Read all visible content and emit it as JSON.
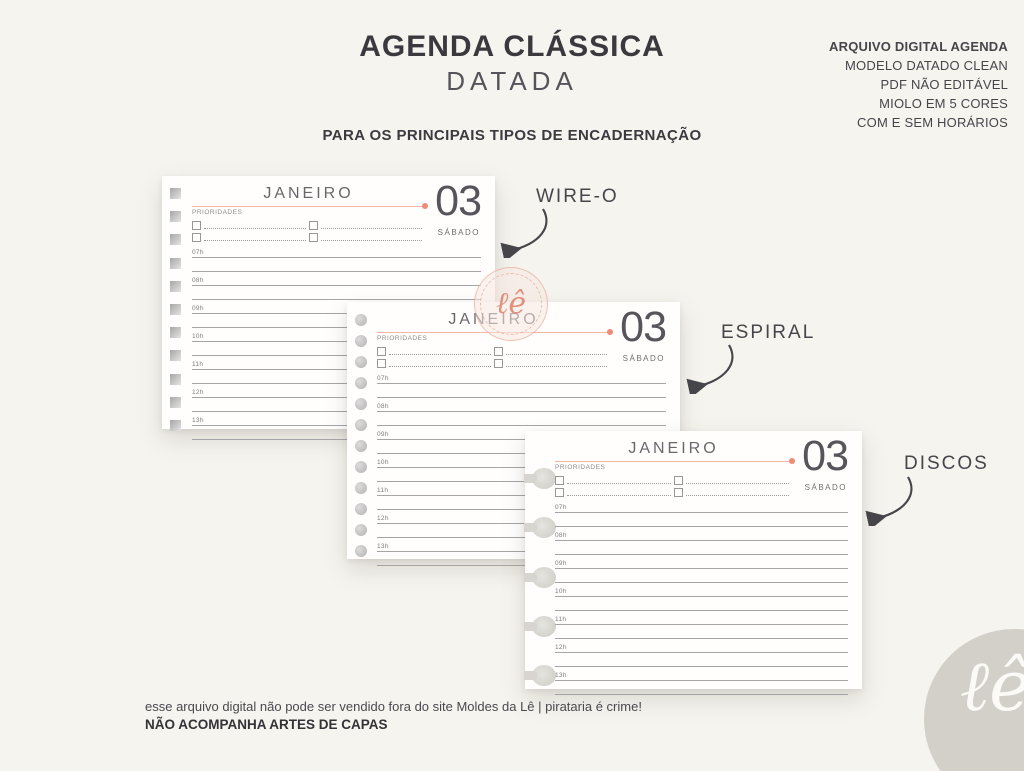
{
  "header": {
    "title": "AGENDA CLÁSSICA",
    "subtitle": "DATADA",
    "info_title": "ARQUIVO DIGITAL AGENDA",
    "info_lines": [
      "MODELO DATADO CLEAN",
      "PDF NÃO EDITÁVEL",
      "MIOLO EM 5 CORES",
      "COM E SEM HORÁRIOS"
    ],
    "tagline": "PARA OS PRINCIPAIS TIPOS DE ENCADERNAÇÃO"
  },
  "planner": {
    "month": "JANEIRO",
    "day_number": "03",
    "weekday": "SÁBADO",
    "priorities_label": "PRIORIDADES",
    "hours": [
      "07h",
      "08h",
      "09h",
      "10h",
      "11h",
      "12h",
      "13h"
    ]
  },
  "bindings": {
    "wireo": "WIRE-O",
    "espiral": "ESPIRAL",
    "discos": "DISCOS"
  },
  "watermark": {
    "script": "ℓê"
  },
  "footer": {
    "line1": "esse arquivo digital não pode ser vendido fora do site Moldes da Lê | pirataria é crime!",
    "line2": "NÃO ACOMPANHA ARTES DE CAPAS"
  },
  "logo": {
    "script": "ℓê"
  },
  "colors": {
    "background": "#f6f4ef",
    "accent_salmon": "#ee8c75",
    "accent_rule": "#f5b5a5",
    "text_dark": "#3a393e",
    "text_gray": "#55545a",
    "line_gray": "#a5a5a7",
    "logo_gray": "#d3d0ca"
  }
}
